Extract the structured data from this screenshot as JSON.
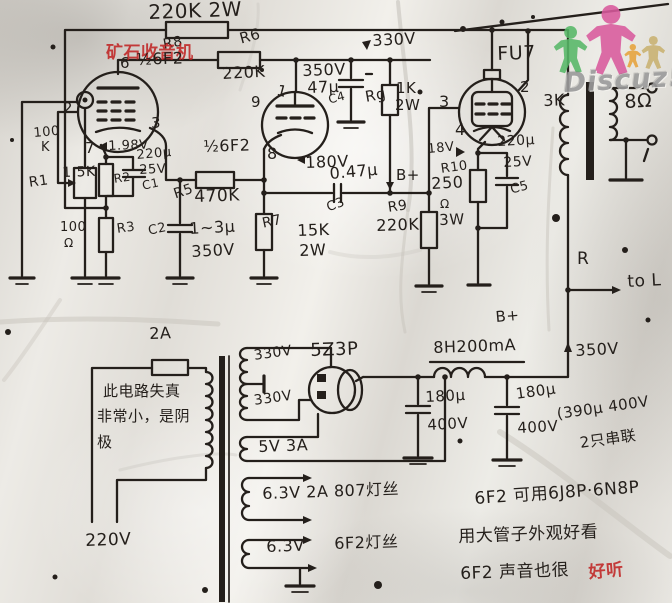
{
  "colors": {
    "ink": "#241f1b",
    "stamp_red": "#c02020",
    "logo_green": "#57b868",
    "logo_pink": "#d95a9d",
    "logo_orange": "#e6a33c",
    "logo_tan": "#c9b271",
    "logo_gray": "#9b9b9b"
  },
  "watermark": {
    "forum_stamp": "矿石收音机",
    "logo_text": "Discuz!"
  },
  "labels": [
    {
      "id": "r8-value",
      "t": "220K 2W",
      "x": 148,
      "y": 2,
      "fs": 20,
      "r": -2
    },
    {
      "id": "r8-ref",
      "t": "R8",
      "x": 162,
      "y": 38,
      "fs": 14,
      "r": -10
    },
    {
      "id": "forum-stamp",
      "t": "矿石收音机",
      "x": 106,
      "y": 45,
      "fs": 17,
      "r": 0,
      "c": "red"
    },
    {
      "id": "r6-ref",
      "t": "R6",
      "x": 238,
      "y": 32,
      "fs": 15,
      "r": -15
    },
    {
      "id": "r6-value",
      "t": "220K",
      "x": 222,
      "y": 66,
      "fs": 16,
      "r": -3
    },
    {
      "id": "t1-pin6",
      "t": "6",
      "x": 120,
      "y": 56,
      "fs": 15
    },
    {
      "id": "t1-name",
      "t": "½6F2",
      "x": 136,
      "y": 52,
      "fs": 16,
      "r": -2
    },
    {
      "id": "t1-pin2",
      "t": "2",
      "x": 63,
      "y": 101,
      "fs": 15
    },
    {
      "id": "t1-pin3",
      "t": "3",
      "x": 151,
      "y": 116,
      "fs": 15
    },
    {
      "id": "t1-pin7",
      "t": "7",
      "x": 85,
      "y": 141,
      "fs": 15
    },
    {
      "id": "t1-cathode-volt",
      "t": "1.98V",
      "x": 108,
      "y": 140,
      "fs": 13,
      "r": -2
    },
    {
      "id": "c1-uf",
      "t": "220μ",
      "x": 136,
      "y": 149,
      "fs": 13,
      "r": -5
    },
    {
      "id": "c1-volt",
      "t": "25V",
      "x": 139,
      "y": 164,
      "fs": 13,
      "r": -3
    },
    {
      "id": "c1-ref",
      "t": "C1",
      "x": 141,
      "y": 180,
      "fs": 12,
      "r": -12
    },
    {
      "id": "r2-value",
      "t": "1.5K",
      "x": 62,
      "y": 166,
      "fs": 14,
      "r": -2
    },
    {
      "id": "r2-ref",
      "t": "R2",
      "x": 113,
      "y": 173,
      "fs": 12,
      "r": -8
    },
    {
      "id": "r3-value",
      "t": "100",
      "x": 60,
      "y": 221,
      "fs": 13
    },
    {
      "id": "r3-ohm",
      "t": "Ω",
      "x": 64,
      "y": 237,
      "fs": 12
    },
    {
      "id": "r3-ref",
      "t": "R3",
      "x": 116,
      "y": 223,
      "fs": 13,
      "r": -8
    },
    {
      "id": "pot-value",
      "t": "100",
      "x": 33,
      "y": 127,
      "fs": 13,
      "r": -5
    },
    {
      "id": "pot-value-k",
      "t": "K",
      "x": 41,
      "y": 141,
      "fs": 13
    },
    {
      "id": "r1-ref",
      "t": "R1",
      "x": 28,
      "y": 176,
      "fs": 14,
      "r": -8
    },
    {
      "id": "r5-ref",
      "t": "R5",
      "x": 172,
      "y": 188,
      "fs": 14,
      "r": -18
    },
    {
      "id": "r5-value",
      "t": "470K",
      "x": 194,
      "y": 189,
      "fs": 17,
      "r": -2
    },
    {
      "id": "c2-ref",
      "t": "C2",
      "x": 147,
      "y": 225,
      "fs": 13,
      "r": -12
    },
    {
      "id": "c2-value",
      "t": "1~3μ",
      "x": 189,
      "y": 221,
      "fs": 16,
      "r": -3
    },
    {
      "id": "c2-volt",
      "t": "350V",
      "x": 191,
      "y": 244,
      "fs": 16,
      "r": -3
    },
    {
      "id": "t2-name",
      "t": "½6F2",
      "x": 203,
      "y": 139,
      "fs": 16,
      "r": -2
    },
    {
      "id": "t2-pin1",
      "t": "1",
      "x": 279,
      "y": 83,
      "fs": 15,
      "r": 15
    },
    {
      "id": "t2-pin9",
      "t": "9",
      "x": 251,
      "y": 95,
      "fs": 15
    },
    {
      "id": "t2-pin8",
      "t": "8",
      "x": 267,
      "y": 146,
      "fs": 16
    },
    {
      "id": "c4-volt",
      "t": "350V",
      "x": 302,
      "y": 63,
      "fs": 16,
      "r": -2
    },
    {
      "id": "c4-uf",
      "t": "47μ",
      "x": 307,
      "y": 80,
      "fs": 16,
      "r": -2
    },
    {
      "id": "c4-ref",
      "t": "C4",
      "x": 327,
      "y": 94,
      "fs": 12,
      "r": -15
    },
    {
      "id": "screen-330v",
      "t": "330V",
      "x": 372,
      "y": 33,
      "fs": 16,
      "r": -3
    },
    {
      "id": "rg-ref",
      "t": "Rg",
      "x": 364,
      "y": 90,
      "fs": 15,
      "r": -10
    },
    {
      "id": "rg-1k",
      "t": "1K",
      "x": 396,
      "y": 81,
      "fs": 15
    },
    {
      "id": "rg-2w",
      "t": "2W",
      "x": 395,
      "y": 98,
      "fs": 15
    },
    {
      "id": "t2-cathode-volt",
      "t": "180V",
      "x": 305,
      "y": 155,
      "fs": 16,
      "r": -2
    },
    {
      "id": "c3-value",
      "t": "0.47μ",
      "x": 329,
      "y": 166,
      "fs": 16,
      "r": -5
    },
    {
      "id": "c3-ref",
      "t": "C3",
      "x": 325,
      "y": 202,
      "fs": 13,
      "r": -20
    },
    {
      "id": "bplus-top",
      "t": "B+",
      "x": 396,
      "y": 168,
      "fs": 15
    },
    {
      "id": "r7-ref",
      "t": "R7",
      "x": 261,
      "y": 217,
      "fs": 14,
      "r": -12
    },
    {
      "id": "r7-value",
      "t": "15K",
      "x": 297,
      "y": 223,
      "fs": 16,
      "r": -2
    },
    {
      "id": "r7-watt",
      "t": "2W",
      "x": 299,
      "y": 243,
      "fs": 16,
      "r": -2
    },
    {
      "id": "r9-ref",
      "t": "R9",
      "x": 387,
      "y": 201,
      "fs": 14,
      "r": -8
    },
    {
      "id": "r9-value",
      "t": "220K",
      "x": 376,
      "y": 218,
      "fs": 16,
      "r": -2
    },
    {
      "id": "fu7-name",
      "t": "FU7",
      "x": 497,
      "y": 45,
      "fs": 19,
      "r": -2
    },
    {
      "id": "fu7-pin3",
      "t": "3",
      "x": 439,
      "y": 94,
      "fs": 16
    },
    {
      "id": "fu7-pin2",
      "t": "2",
      "x": 520,
      "y": 80,
      "fs": 15
    },
    {
      "id": "fu7-pin4",
      "t": "4",
      "x": 455,
      "y": 122,
      "fs": 16
    },
    {
      "id": "fu7-cathode-volt",
      "t": "18V",
      "x": 427,
      "y": 143,
      "fs": 13,
      "r": -5
    },
    {
      "id": "r10-ref",
      "t": "R10",
      "x": 440,
      "y": 163,
      "fs": 13,
      "r": -8
    },
    {
      "id": "r10-value",
      "t": "250",
      "x": 431,
      "y": 176,
      "fs": 16,
      "r": -3
    },
    {
      "id": "r10-ohm",
      "t": "Ω",
      "x": 440,
      "y": 198,
      "fs": 12
    },
    {
      "id": "r10-watt",
      "t": "3W",
      "x": 439,
      "y": 213,
      "fs": 15,
      "r": -2
    },
    {
      "id": "c5-uf",
      "t": "220μ",
      "x": 497,
      "y": 135,
      "fs": 14,
      "r": -3
    },
    {
      "id": "c5-volt",
      "t": "25V",
      "x": 503,
      "y": 156,
      "fs": 14,
      "r": -3
    },
    {
      "id": "c5-ref",
      "t": "C5",
      "x": 509,
      "y": 184,
      "fs": 13,
      "r": -15
    },
    {
      "id": "opt-primary",
      "t": "3K",
      "x": 543,
      "y": 93,
      "fs": 16,
      "r": -2
    },
    {
      "id": "opt-secondary",
      "t": "8Ω",
      "x": 624,
      "y": 93,
      "fs": 19,
      "r": -3
    },
    {
      "id": "feedback-r",
      "t": "R",
      "x": 577,
      "y": 251,
      "fs": 17
    },
    {
      "id": "to-l",
      "t": "to L",
      "x": 627,
      "y": 274,
      "fs": 17,
      "r": -3
    },
    {
      "id": "bplus-mid",
      "t": "B+",
      "x": 495,
      "y": 310,
      "fs": 15,
      "r": -5
    },
    {
      "id": "bplus-350v",
      "t": "350V",
      "x": 575,
      "y": 343,
      "fs": 16,
      "r": -3
    },
    {
      "id": "choke-value",
      "t": "8H200mA",
      "x": 433,
      "y": 340,
      "fs": 16,
      "r": -2
    },
    {
      "id": "c6-uf",
      "t": "180μ",
      "x": 425,
      "y": 390,
      "fs": 15,
      "r": -3
    },
    {
      "id": "c6-volt",
      "t": "400V",
      "x": 427,
      "y": 418,
      "fs": 15,
      "r": -3
    },
    {
      "id": "c7-uf",
      "t": "180μ",
      "x": 515,
      "y": 387,
      "fs": 15,
      "r": -8
    },
    {
      "id": "c7-volt",
      "t": "400V",
      "x": 517,
      "y": 421,
      "fs": 15,
      "r": -3
    },
    {
      "id": "cap-note-1",
      "t": "(390μ 400V",
      "x": 556,
      "y": 407,
      "fs": 15,
      "r": -8
    },
    {
      "id": "cap-note-2",
      "t": "2只串联",
      "x": 579,
      "y": 436,
      "fs": 15,
      "r": -8
    },
    {
      "id": "fuse-value",
      "t": "2A",
      "x": 149,
      "y": 326,
      "fs": 16,
      "r": -2
    },
    {
      "id": "note-left-1",
      "t": "此电路失真",
      "x": 103,
      "y": 384,
      "fs": 15
    },
    {
      "id": "note-left-2",
      "t": "非常小，是阴",
      "x": 97,
      "y": 409,
      "fs": 15
    },
    {
      "id": "note-left-3",
      "t": "极",
      "x": 97,
      "y": 435,
      "fs": 15
    },
    {
      "id": "mains-volt",
      "t": "220V",
      "x": 85,
      "y": 533,
      "fs": 17,
      "r": -2
    },
    {
      "id": "hv-winding-1",
      "t": "330V",
      "x": 253,
      "y": 349,
      "fs": 14,
      "r": -8
    },
    {
      "id": "hv-winding-2",
      "t": "330V",
      "x": 253,
      "y": 394,
      "fs": 14,
      "r": -8
    },
    {
      "id": "rectifier-name",
      "t": "5Z3P",
      "x": 310,
      "y": 342,
      "fs": 18,
      "r": -2
    },
    {
      "id": "fil-5v",
      "t": "5V 3A",
      "x": 258,
      "y": 439,
      "fs": 16,
      "r": -2
    },
    {
      "id": "fil-807",
      "t": "6.3V 2A 807灯丝",
      "x": 262,
      "y": 486,
      "fs": 16,
      "r": -2
    },
    {
      "id": "fil-6f2-volt",
      "t": "6.3V",
      "x": 266,
      "y": 539,
      "fs": 16,
      "r": -2
    },
    {
      "id": "fil-6f2",
      "t": "6F2灯丝",
      "x": 334,
      "y": 536,
      "fs": 16,
      "r": -2
    },
    {
      "id": "note-right-1",
      "t": "6F2 可用6J8P·6N8P",
      "x": 474,
      "y": 491,
      "fs": 17,
      "r": -4
    },
    {
      "id": "note-right-2",
      "t": "用大管子外观好看",
      "x": 458,
      "y": 529,
      "fs": 17,
      "r": -2
    },
    {
      "id": "note-right-3",
      "t": "6F2 声音也很",
      "x": 460,
      "y": 566,
      "fs": 17,
      "r": -2
    },
    {
      "id": "note-right-3-red",
      "t": "好听",
      "x": 588,
      "y": 565,
      "fs": 17,
      "r": -5,
      "c": "red"
    },
    {
      "id": "discuz-logo-text",
      "t": "Discuz!",
      "x": 563,
      "y": 70,
      "fs": 27,
      "r": -3,
      "c": "gray"
    }
  ]
}
